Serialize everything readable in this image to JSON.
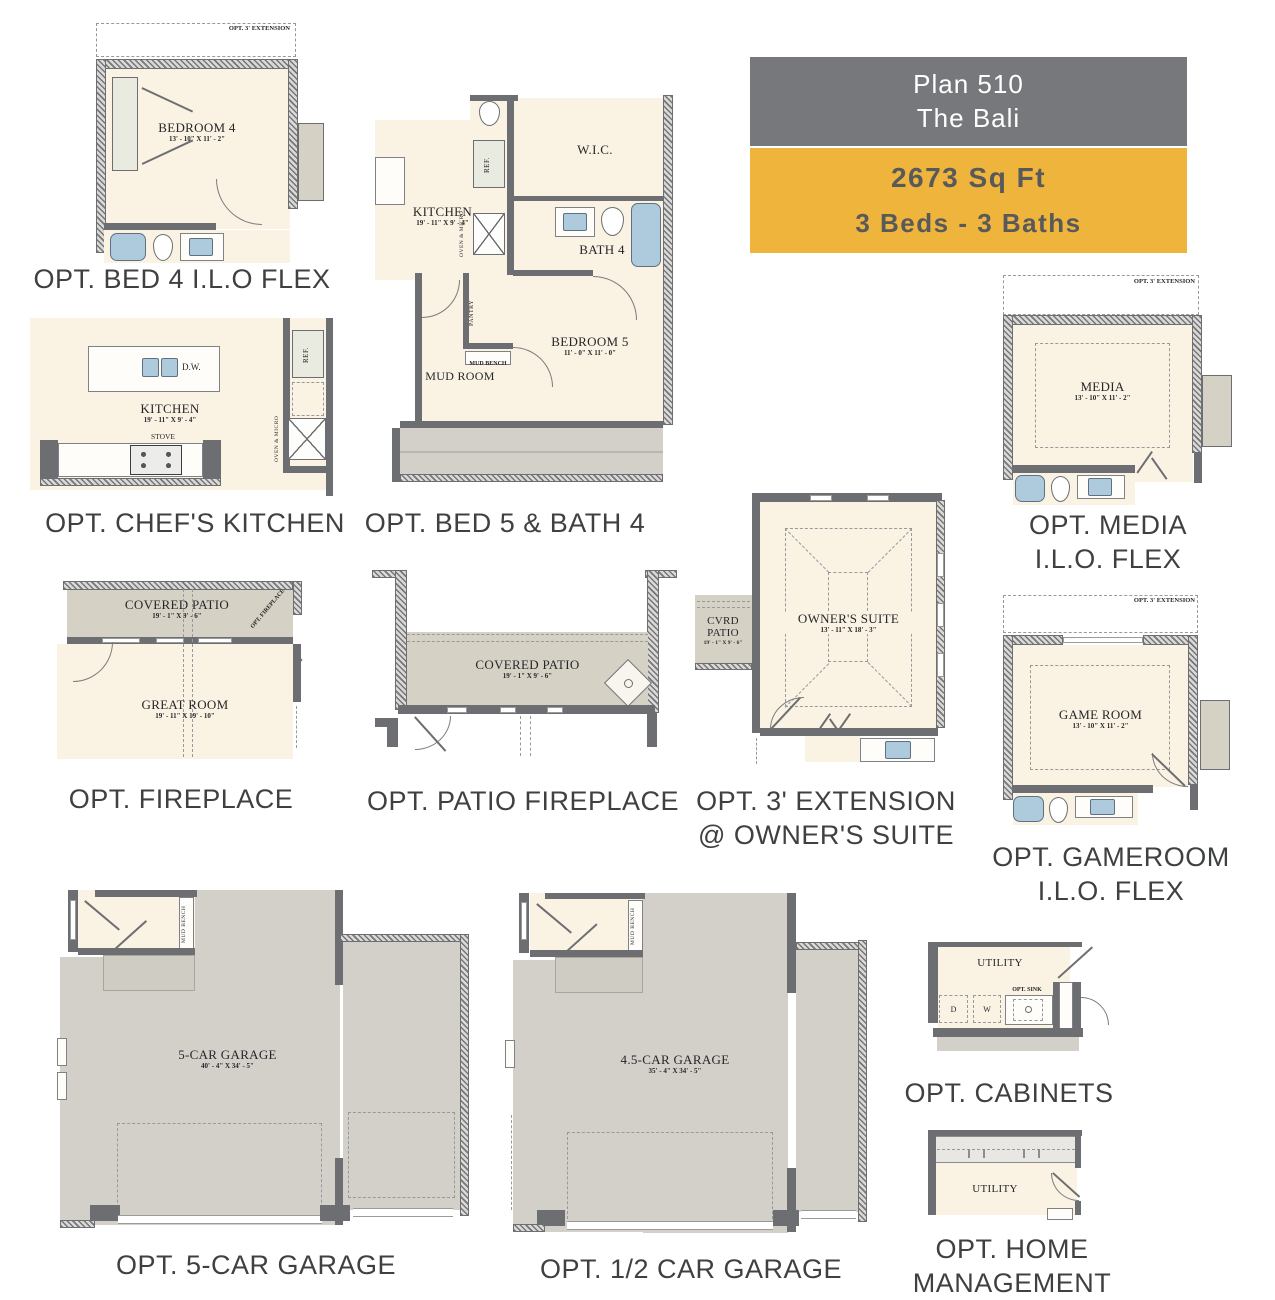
{
  "colors": {
    "header_gray": "#77787b",
    "accent_yellow": "#eeb43c",
    "wall_gray": "#6d6e71",
    "room_cream": "#faf3e3",
    "patio_gray": "#d5d2c5",
    "garage_gray": "#d3d0ca",
    "fixture_blue": "#aecbdd",
    "caption_text": "#3f4041"
  },
  "header": {
    "plan_line1": "Plan 510",
    "plan_line2": "The Bali",
    "sqft": "2673 Sq Ft",
    "beds_baths": "3 Beds - 3 Baths"
  },
  "plans": {
    "bed4": {
      "caption": "OPT. BED 4 I.L.O FLEX",
      "ext": "OPT. 3' EXTENSION",
      "room": "BEDROOM 4",
      "dims": "13' - 10\" X 11' - 2\""
    },
    "chefs": {
      "caption": "OPT. CHEF'S KITCHEN",
      "room": "KITCHEN",
      "dims": "19' - 11\" X 9' - 4\"",
      "dw": "D.W.",
      "stove": "STOVE",
      "ref": "REF.",
      "oven": "OVEN & MICRO"
    },
    "bed5": {
      "caption": "OPT. BED 5 & BATH 4",
      "kitchen": "KITCHEN",
      "kitchen_dims": "19' - 11\" X 9' - 4\"",
      "ref": "REF.",
      "oven": "OVEN & MICRO",
      "pantry": "PANTRY",
      "wic": "W.I.C.",
      "bath": "BATH 4",
      "bedroom": "BEDROOM 5",
      "bedroom_dims": "11' - 0\" X 11' - 0\"",
      "mudroom": "MUD ROOM",
      "mudbench": "MUD BENCH"
    },
    "media": {
      "caption1": "OPT. MEDIA",
      "caption2": "I.L.O. FLEX",
      "ext": "OPT. 3' EXTENSION",
      "room": "MEDIA",
      "dims": "13' - 10\" X 11' - 2\""
    },
    "fireplace": {
      "caption": "OPT. FIREPLACE",
      "patio": "COVERED PATIO",
      "patio_dims": "19' - 1\" X 9' - 6\"",
      "corner_label": "OPT. FIREPLACE",
      "room": "GREAT ROOM",
      "dims": "19' - 11\" X 19' - 10\""
    },
    "patiofp": {
      "caption": "OPT. PATIO FIREPLACE",
      "patio": "COVERED PATIO",
      "dims": "19' - 1\" X 9' - 6\""
    },
    "owners": {
      "caption1": "OPT. 3' EXTENSION",
      "caption2": "@ OWNER'S SUITE",
      "room": "OWNER'S SUITE",
      "dims": "13' - 11\" X 18' - 3\"",
      "cvrd": "CVRD PATIO",
      "cvrd_dims": "19' - 1\" X 9' - 6\""
    },
    "gameroom": {
      "caption1": "OPT. GAMEROOM",
      "caption2": "I.L.O. FLEX",
      "ext": "OPT. 3' EXTENSION",
      "room": "GAME ROOM",
      "dims": "13' - 10\" X 11' - 2\""
    },
    "garage5": {
      "caption": "OPT. 5-CAR GARAGE",
      "room": "5-CAR GARAGE",
      "dims": "40' - 4\" X 34' - 5\"",
      "mudbench": "MUD BENCH"
    },
    "garage45": {
      "caption": "OPT. 1/2 CAR GARAGE",
      "room": "4.5-CAR GARAGE",
      "dims": "35' - 4\" X 34' - 5\"",
      "mudbench": "MUD BENCH"
    },
    "cabinets": {
      "caption": "OPT. CABINETS",
      "room": "UTILITY",
      "d": "D",
      "w": "W",
      "sink": "OPT. SINK"
    },
    "homemgmt": {
      "caption1": "OPT. HOME",
      "caption2": "MANAGEMENT",
      "room": "UTILITY"
    }
  }
}
